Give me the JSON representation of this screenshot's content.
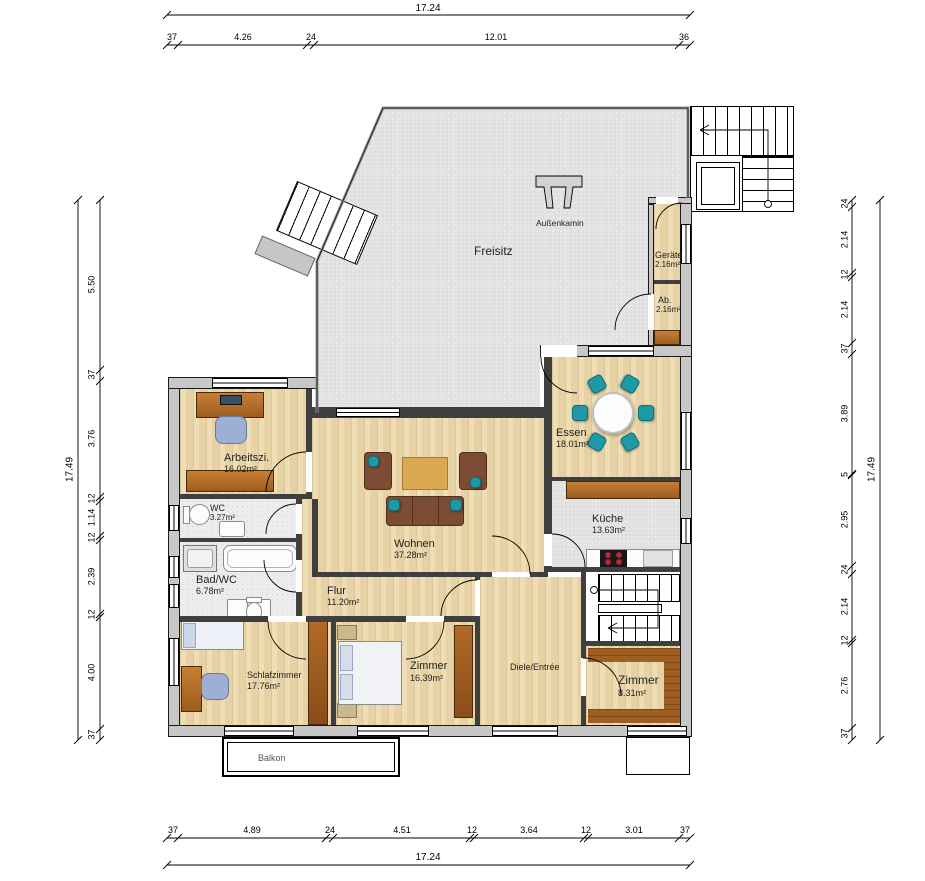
{
  "plan": {
    "rooms": {
      "freisitz": {
        "name": "Freisitz"
      },
      "aussenkamin": {
        "name": "Außenkamin"
      },
      "geraete": {
        "name": "Geräte",
        "area": "2.16m²"
      },
      "abstell": {
        "name": "Ab.",
        "area": "2.16m²"
      },
      "essen": {
        "name": "Essen",
        "area": "18.01m²"
      },
      "kueche": {
        "name": "Küche",
        "area": "13.63m²"
      },
      "wohnen": {
        "name": "Wohnen",
        "area": "37.28m²"
      },
      "arbeitszimmer": {
        "name": "Arbeitszi.",
        "area": "16.02m²"
      },
      "wc": {
        "name": "WC",
        "area": "3.27m²"
      },
      "bad": {
        "name": "Bad/WC",
        "area": "6.78m²"
      },
      "flur": {
        "name": "Flur",
        "area": "11.20m²"
      },
      "schlafzimmer": {
        "name": "Schlafzimmer",
        "area": "17.76m²"
      },
      "zimmer1": {
        "name": "Zimmer",
        "area": "16.39m²"
      },
      "diele": {
        "name": "Diele/Entrée"
      },
      "zimmer2": {
        "name": "Zimmer",
        "area": "8.31m²"
      },
      "balkon": {
        "name": "Balkon"
      }
    },
    "dimensions": {
      "top": {
        "total": "17.24",
        "segments": [
          "37",
          "4.26",
          "24",
          "12.01",
          "36"
        ]
      },
      "bottom": {
        "total": "17.24",
        "segments": [
          "37",
          "4.89",
          "24",
          "4.51",
          "12",
          "3.64",
          "12",
          "3.01",
          "37"
        ]
      },
      "left": {
        "total": "17.49",
        "segments": [
          "5.50",
          "37",
          "3.76",
          "12",
          "1.14",
          "12",
          "2.39",
          "12",
          "4.00",
          "37"
        ]
      },
      "right": {
        "total": "17.49",
        "segments": [
          "24",
          "2.14",
          "12",
          "2.14",
          "37",
          "3.89",
          "5",
          "2.95",
          "24",
          "2.14",
          "12",
          "2.76",
          "37"
        ]
      }
    },
    "colors": {
      "wood_floor": "#ecd9ad",
      "terrace_gray": "#e4e4e4",
      "wall_gray": "#c7c7c7",
      "interior_wall": "#3f3f3f",
      "sofa_brown": "#7c4c34",
      "counter_wood": "#b5722e",
      "wardrobe_wood": "#b06a28",
      "dark_wood": "#a05f22",
      "dining_chair_teal": "#1d9aa6",
      "office_chair_blue": "#9db0d4"
    }
  }
}
